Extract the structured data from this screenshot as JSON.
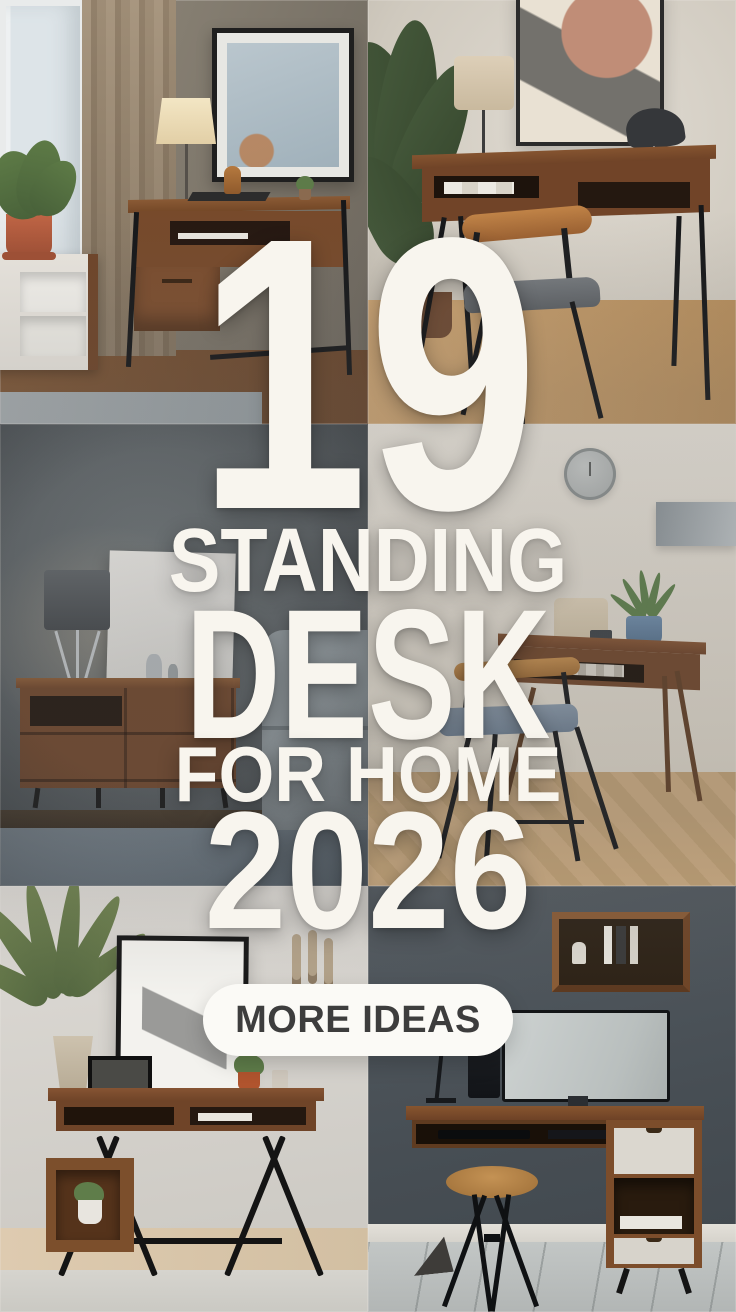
{
  "poster": {
    "headline": {
      "number": "19",
      "line1": "STANDING",
      "line2": "DESK",
      "line3": "FOR HOME",
      "line4": "2026"
    },
    "cta": {
      "label": "MORE IDEAS"
    },
    "colors": {
      "headline_text": "#f8f5ee",
      "cta_background": "#fbfaf6",
      "cta_text": "#3d3d3d"
    },
    "photos": [
      {
        "id": "top-left",
        "description": "Walnut desk with black metal legs beside a window with beige curtains, framed art, table lamp, white sideboard with terracotta potted plant and gray rug"
      },
      {
        "id": "top-right",
        "description": "Walnut desk with open shelf and black legs, wooden chair with gray cushion, beige table lamp, dark bird sculpture, abstract framed art and leafy plant"
      },
      {
        "id": "middle-left",
        "description": "Dark moody room with walnut sideboard, drum-shade tripod lamp, leaning white canvas, silver figurines, gray sofa and blue-gray rug"
      },
      {
        "id": "middle-right",
        "description": "Small wall-mounted walnut desk with book shelf, black chair with blue cushion, plant in blue pot, wall clock and lamp on cream wall, herringbone floor"
      },
      {
        "id": "bottom-left",
        "description": "Walnut console desk with black X legs, cube shelf with white potted plant, tall palm, leaning black framed art and small frame"
      },
      {
        "id": "bottom-right",
        "description": "Floating walnut desk with white drawer cabinet, monitor, speaker, lamp, wall box shelf with books and round wooden stool on gray tile floor"
      }
    ]
  }
}
